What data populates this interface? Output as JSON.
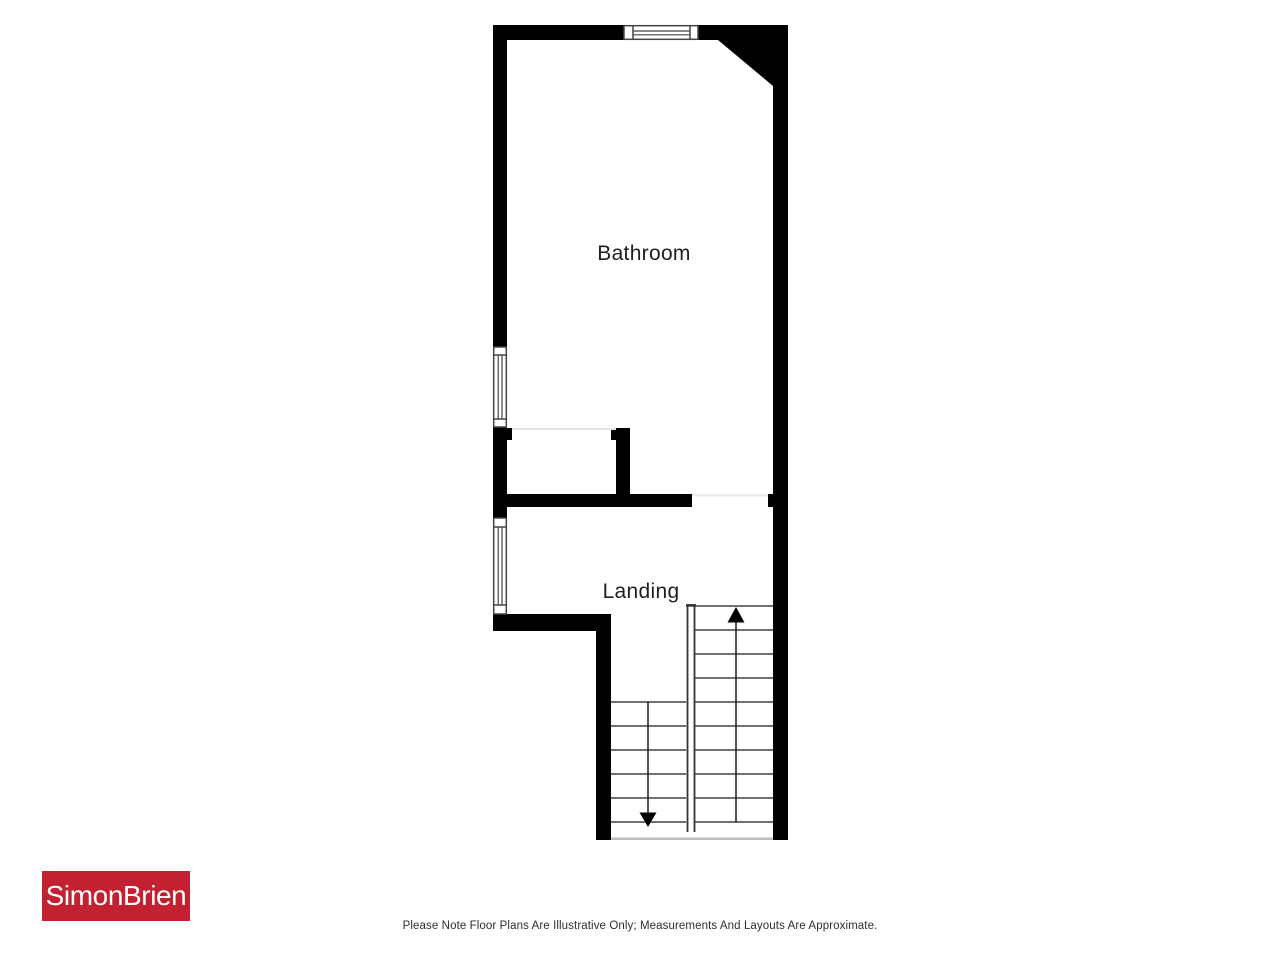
{
  "floorplan": {
    "rooms": [
      {
        "label": "Bathroom"
      },
      {
        "label": "Landing"
      }
    ],
    "stairs": {
      "up_arrow": "up-direction",
      "down_arrow": "down-direction"
    },
    "colors": {
      "wall": "#000000",
      "stair_line": "#404040",
      "divider_line": "#333333",
      "window_line": "#444444",
      "opening_line_light": "#ececec",
      "cupboard_line": "#e3e3e3",
      "bottom_opening_line": "#bdbdbd"
    }
  },
  "branding": {
    "logo_text": "SimonBrien",
    "logo_bg": "#c32031",
    "logo_text_color": "#ffffff"
  },
  "footer": {
    "disclaimer": "Please Note Floor Plans Are Illustrative Only; Measurements And Layouts Are Approximate."
  }
}
